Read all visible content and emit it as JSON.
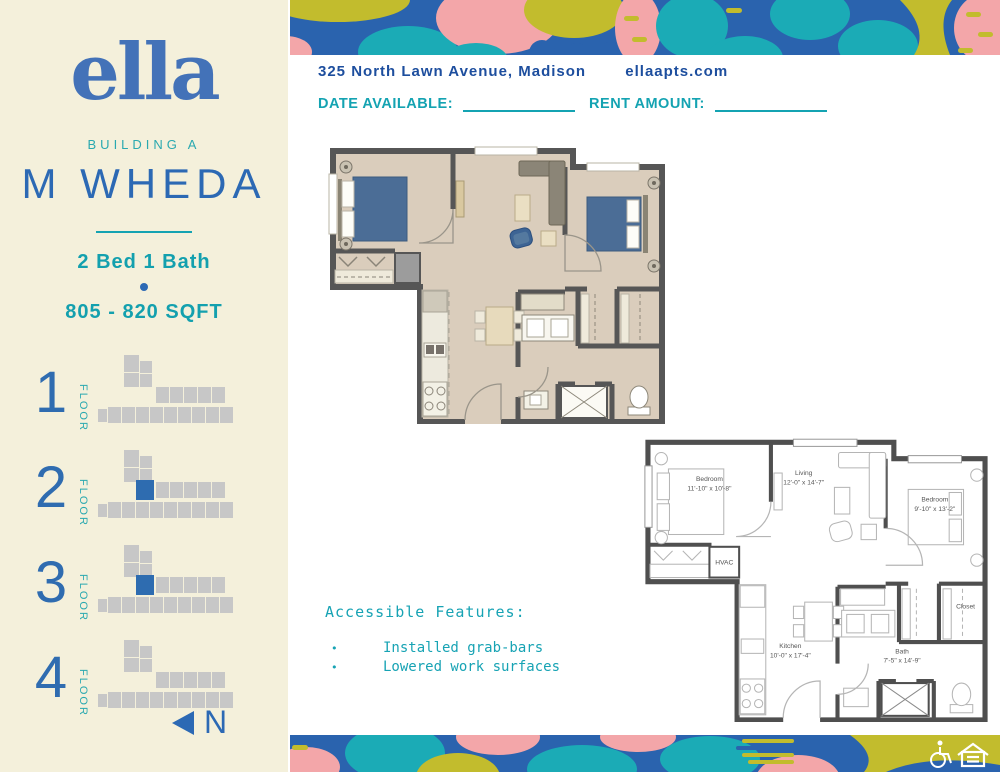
{
  "sidebar": {
    "logo": "ella",
    "building": "BUILDING A",
    "unit_name": "M WHEDA",
    "bed_bath": "2 Bed 1 Bath",
    "sqft": "805 - 820 SQFT",
    "floors": [
      {
        "number": "1",
        "label": "FLOOR",
        "highlighted": false
      },
      {
        "number": "2",
        "label": "FLOOR",
        "highlighted": true
      },
      {
        "number": "3",
        "label": "FLOOR",
        "highlighted": true
      },
      {
        "number": "4",
        "label": "FLOOR",
        "highlighted": false
      }
    ],
    "north_label": "N"
  },
  "header": {
    "address": "325 North Lawn Avenue, Madison",
    "website": "ellaapts.com",
    "date_available_label": "DATE AVAILABLE:",
    "date_available_value": "",
    "rent_amount_label": "RENT AMOUNT:",
    "rent_amount_value": ""
  },
  "accessible_features": {
    "title": "Accessible Features:",
    "bullet": "•",
    "items": [
      "Installed grab-bars",
      "Lowered work surfaces"
    ]
  },
  "bw_plan": {
    "bedroom1": {
      "name": "Bedroom",
      "dims": "11'-10\" x 10'-8\""
    },
    "living": {
      "name": "Living",
      "dims": "12'-0\" x 14'-7\""
    },
    "bedroom2": {
      "name": "Bedroom",
      "dims": "9'-10\" x 13'-2\""
    },
    "hvac": "HVAC",
    "kitchen": {
      "name": "Kitchen",
      "dims": "10'-0\" x 17'-4\""
    },
    "bath": {
      "name": "Bath",
      "dims": "7'-5\" x 14'-9\""
    },
    "closet": "Closet"
  },
  "colors": {
    "cream": "#f4f0db",
    "brand_blue": "#4372b8",
    "unit_name_blue": "#2c69b4",
    "teal": "#14a3b2",
    "address_blue": "#1d4e9e",
    "band_blue": "#2a63ae",
    "band_teal": "#1babb6",
    "band_pink": "#f3a6a9",
    "band_olive": "#c2bc2d",
    "highlight_unit_blue": "#2e6cb0",
    "plan_floor_tan": "#dacdbc",
    "plan_wall_gray": "#565656",
    "bed_blue": "#4b6d96"
  },
  "footer_icons": [
    "wheelchair-icon",
    "equal-housing-icon"
  ]
}
